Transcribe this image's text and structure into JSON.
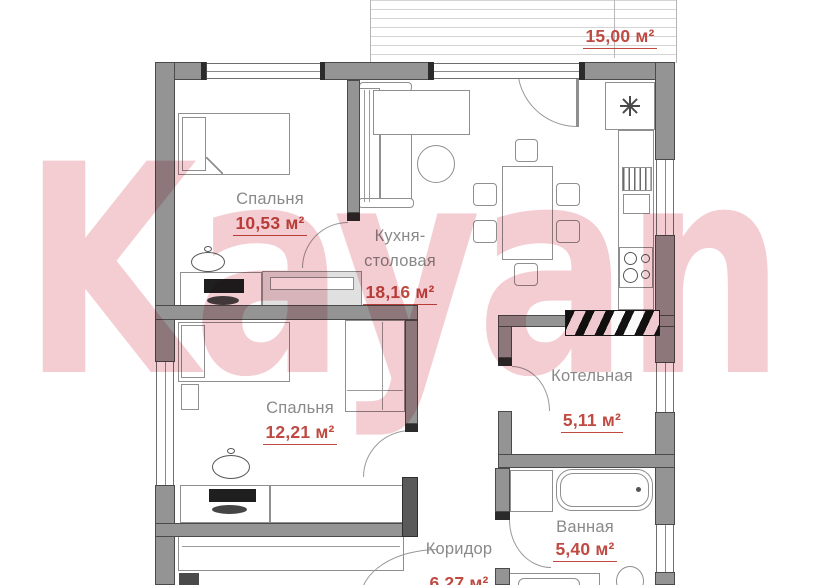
{
  "watermark_text": "Kayan",
  "terrace": {
    "area_label": "15,00 м²"
  },
  "rooms": {
    "bedroom1": {
      "name": "Спальня",
      "area": "10,53 м²"
    },
    "kitchen": {
      "name": "Кухня-столовая",
      "area": "18,16 м²"
    },
    "bedroom2": {
      "name": "Спальня",
      "area": "12,21 м²"
    },
    "boiler": {
      "name": "Котельная",
      "area": "5,11 м²"
    },
    "bathroom": {
      "name": "Ванная",
      "area": "5,40 м²"
    },
    "corridor": {
      "name": "Коридор",
      "area": "6,27 м²"
    }
  },
  "icons": {
    "vent_star": "✳"
  },
  "colors": {
    "area_text": "#bf4a42",
    "room_text": "#898989",
    "wall_fill": "#949494",
    "watermark_pink": "#f4cdd3",
    "hatch_line": "#d4d4d4"
  }
}
